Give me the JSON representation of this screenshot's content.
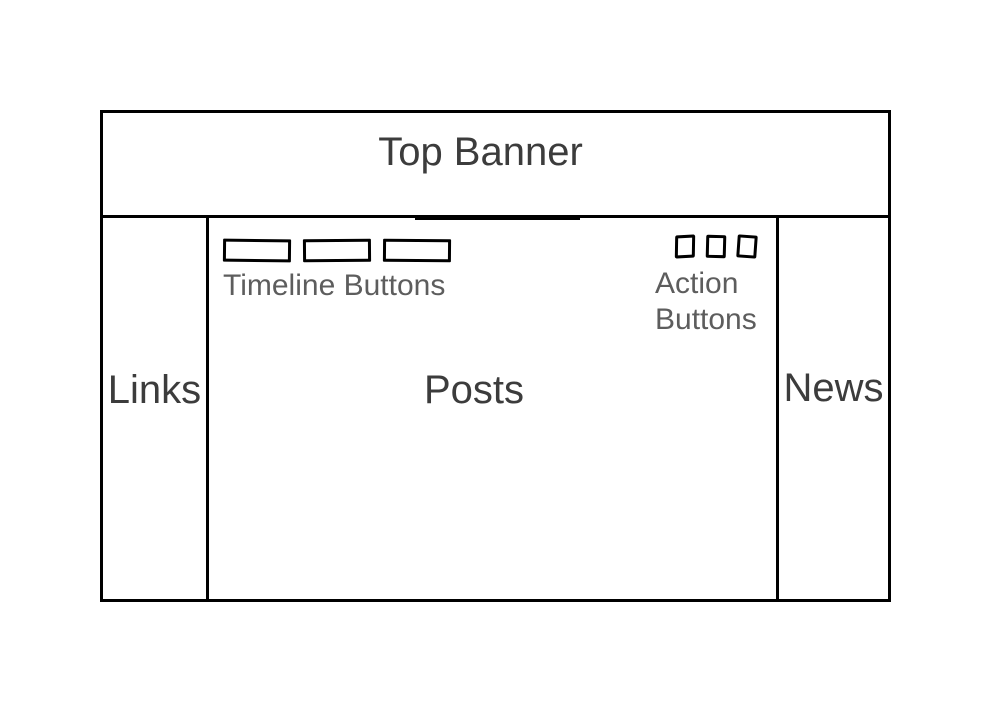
{
  "wireframe": {
    "banner": {
      "label": "Top Banner"
    },
    "left_sidebar": {
      "label": "Links"
    },
    "main": {
      "label": "Posts",
      "timeline_buttons": {
        "caption": "Timeline Buttons",
        "count": 3
      },
      "action_buttons": {
        "caption_line1": "Action",
        "caption_line2": "Buttons",
        "count": 3
      }
    },
    "right_sidebar": {
      "label": "News"
    },
    "colors": {
      "line": "#000000",
      "section_label_text": "#3c3c3c",
      "caption_text": "#5d5d5d",
      "background": "#ffffff"
    }
  }
}
